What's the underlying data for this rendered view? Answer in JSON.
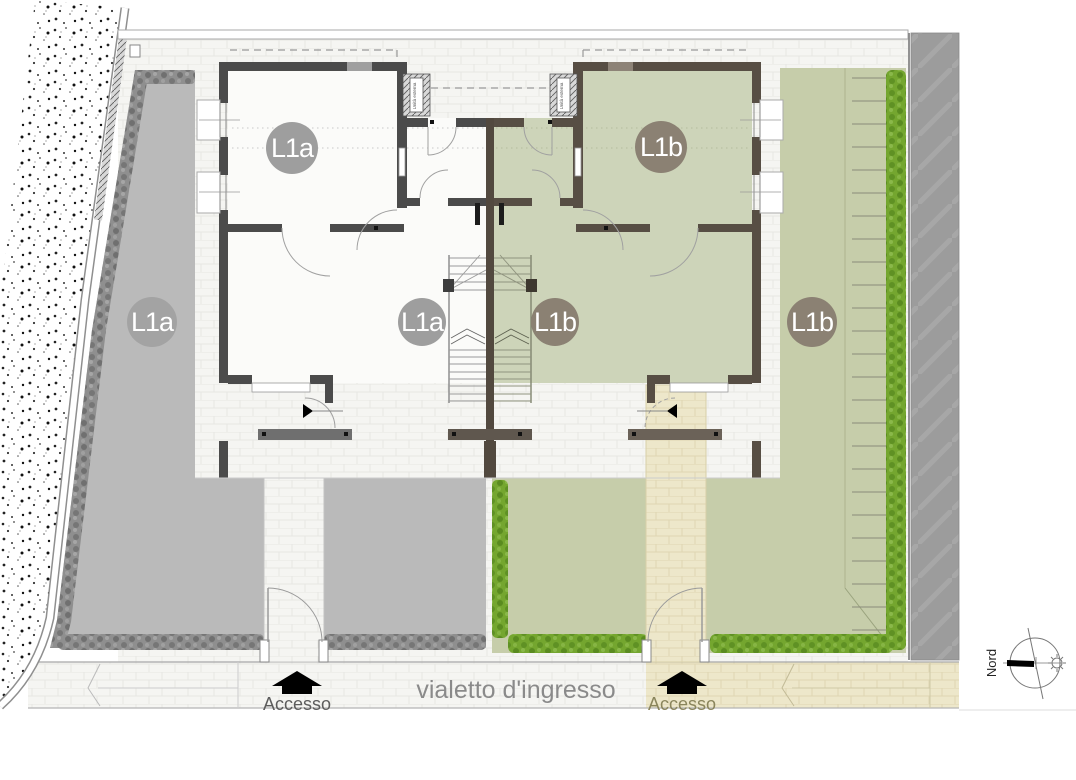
{
  "drawing": {
    "type": "site-floor-plan",
    "units": {
      "a": "L1a",
      "b": "L1b"
    },
    "labels": {
      "garden_a": "L1a",
      "bedroom_a": "L1a",
      "living_a": "L1a",
      "bedroom_b": "L1b",
      "living_b": "L1b",
      "garden_b": "L1b",
      "walkway": "vialetto d'ingresso",
      "access_a": "Accesso",
      "access_b": "Accesso",
      "compass_north": "Nord",
      "ac_unit": "Unità esterna"
    },
    "colors": {
      "floor_unit_a": "#fbfbf9",
      "floor_unit_b": "#cdd4b9",
      "garden_a_gray": "#bababa",
      "garden_b_green": "#c6cdaa",
      "hedge_bright_green": "#74a62f",
      "hedge_gray": "#8f8f8f",
      "wall_unit_a": "#4b4b4b",
      "wall_unit_b": "#574e44",
      "path_beige": "#ede7ca",
      "road_gray": "#9c9c9c",
      "badge_a": "#9e9e9e",
      "badge_b": "#8b8173"
    }
  }
}
